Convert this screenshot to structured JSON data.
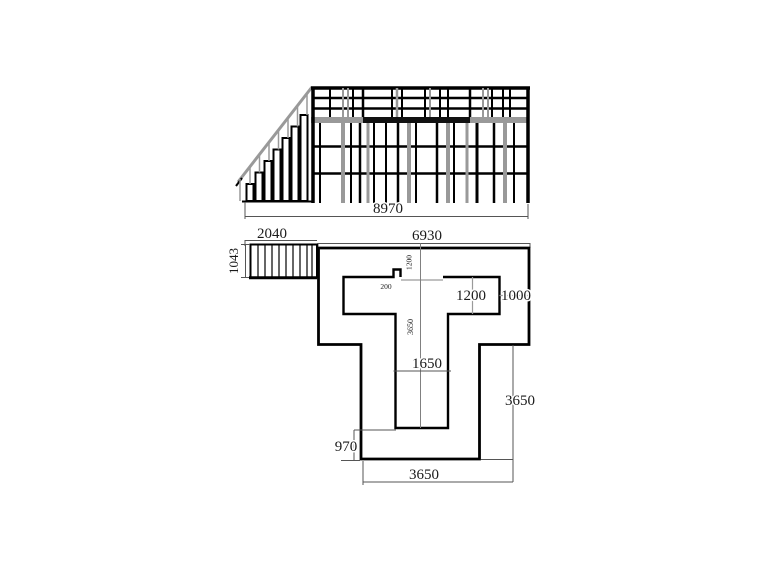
{
  "drawing": {
    "background": "#ffffff",
    "ink_color": "#000000",
    "accent_gray": "#999999"
  },
  "elevation_view": {
    "overall_width_dim": "8970"
  },
  "plan_view": {
    "deck_width_dim": "6930",
    "stair_flight_width_dim": "2040",
    "stair_flight_depth_dim": "1043",
    "opening_top_offset_dim": "1200",
    "notch_width_dim": "200",
    "opening_height_dim": "1200",
    "right_margin_dim": "1000",
    "inner_stem_depth_dim": "3650",
    "inner_stem_width_dim": "1650",
    "stem_bottom_offset_dim": "970",
    "stem_side_height_dim": "3650",
    "stem_bottom_width_dim": "3650"
  }
}
